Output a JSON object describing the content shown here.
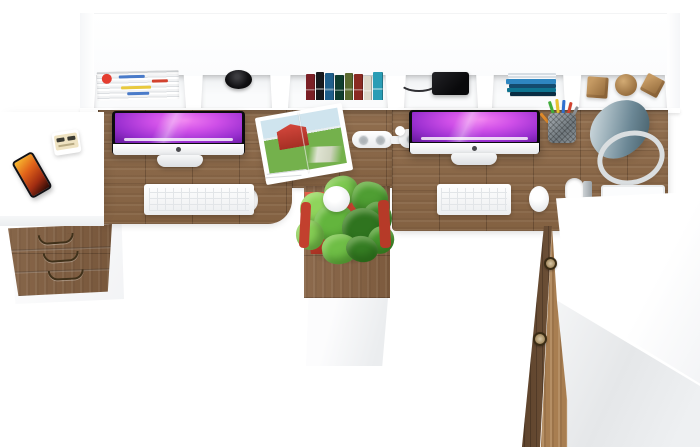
{
  "scene": {
    "type": "furniture product photo",
    "view": "top-down",
    "subject": "Two-person L-shaped office workstation: wood desktops with white hutch cubbies, two iMac computers, side table, three-drawer unit, plant pedestal, desk lamp and wardrobe cabinet",
    "background": "#ffffff"
  },
  "palette": {
    "desk_wood": "#8b6746",
    "wood_dark": "#6b4c31",
    "wood_light": "#a87e51",
    "furniture_white": "#ffffff",
    "panel_gray": "#e8eaec",
    "screen_purple": "#cf4fe8",
    "screen_dark": "#23073f",
    "plant_green": "#57aa36",
    "pot_red": "#c2402e",
    "lamp_blue_gray": "#7d98a3",
    "handle_bronze": "#40311a",
    "phone_screen_orange": "#e2641a"
  },
  "items": {
    "hutch": {
      "label": "white hutch with open cubbies"
    },
    "magazine_stack": {
      "label": "stack of magazines lying flat",
      "mark_colors": [
        "#e43d30",
        "#4a7bc9",
        "#d2422f",
        "#e8c93e",
        "#4a7bc9"
      ]
    },
    "black_pot": {
      "label": "black cup seen from above"
    },
    "book_row": {
      "label": "row of standing books",
      "spine_colors": [
        "#7b2026",
        "#17191d",
        "#1f5f8b",
        "#0f3d2e",
        "#5a6a2f",
        "#8a2a22",
        "#ddd8ca",
        "#2a9db5"
      ]
    },
    "laptop": {
      "label": "closed black laptop with cable"
    },
    "flat_book_stack": {
      "label": "stack of books lying flat",
      "cover_colors": [
        "#d7dee4",
        "#2e86c1",
        "#134b6e",
        "#0e7490",
        "#0a2e44"
      ]
    },
    "wood_blocks": {
      "label": "wooden toy cube, sphere and tilted cube"
    },
    "imac_left": {
      "label": "iMac computer (left workplace)"
    },
    "imac_right": {
      "label": "iMac computer (right workplace)"
    },
    "keyboard": {
      "label": "white keyboard"
    },
    "mouse": {
      "label": "white mouse"
    },
    "open_magazine": {
      "label": "open magazine with red barn photo"
    },
    "power_strip": {
      "label": "white power strip"
    },
    "pencil_cup": {
      "label": "wire pencil cup with pens",
      "pen_colors": [
        "#3fae3a",
        "#e8c32e",
        "#2f6fd0",
        "#d2422f",
        "#8c9196",
        "#e08a2a"
      ]
    },
    "desk_lamp": {
      "label": "blue-gray cone desk lamp"
    },
    "potted_plant": {
      "label": "green plant in red pot on pedestal",
      "leaf_colors": [
        "#7cc84f",
        "#4f9e33",
        "#8fd45c",
        "#3c8527",
        "#63b53d",
        "#2f741f",
        "#86ce55",
        "#45962d",
        "#6fbe46",
        "#357d23"
      ]
    },
    "smartphone": {
      "label": "smartphone with fire wallpaper"
    },
    "socket_device": {
      "label": "small beige socket block"
    },
    "tray": {
      "label": "white tray"
    },
    "grommet": {
      "label": "cable grommet hole"
    },
    "side_table": {
      "label": "white side table"
    },
    "drawer_unit": {
      "label": "three-drawer cabinet with bronze handles"
    },
    "return_desk": {
      "label": "white L-return desktop"
    },
    "wardrobe": {
      "label": "wardrobe cabinet with wood door"
    }
  }
}
